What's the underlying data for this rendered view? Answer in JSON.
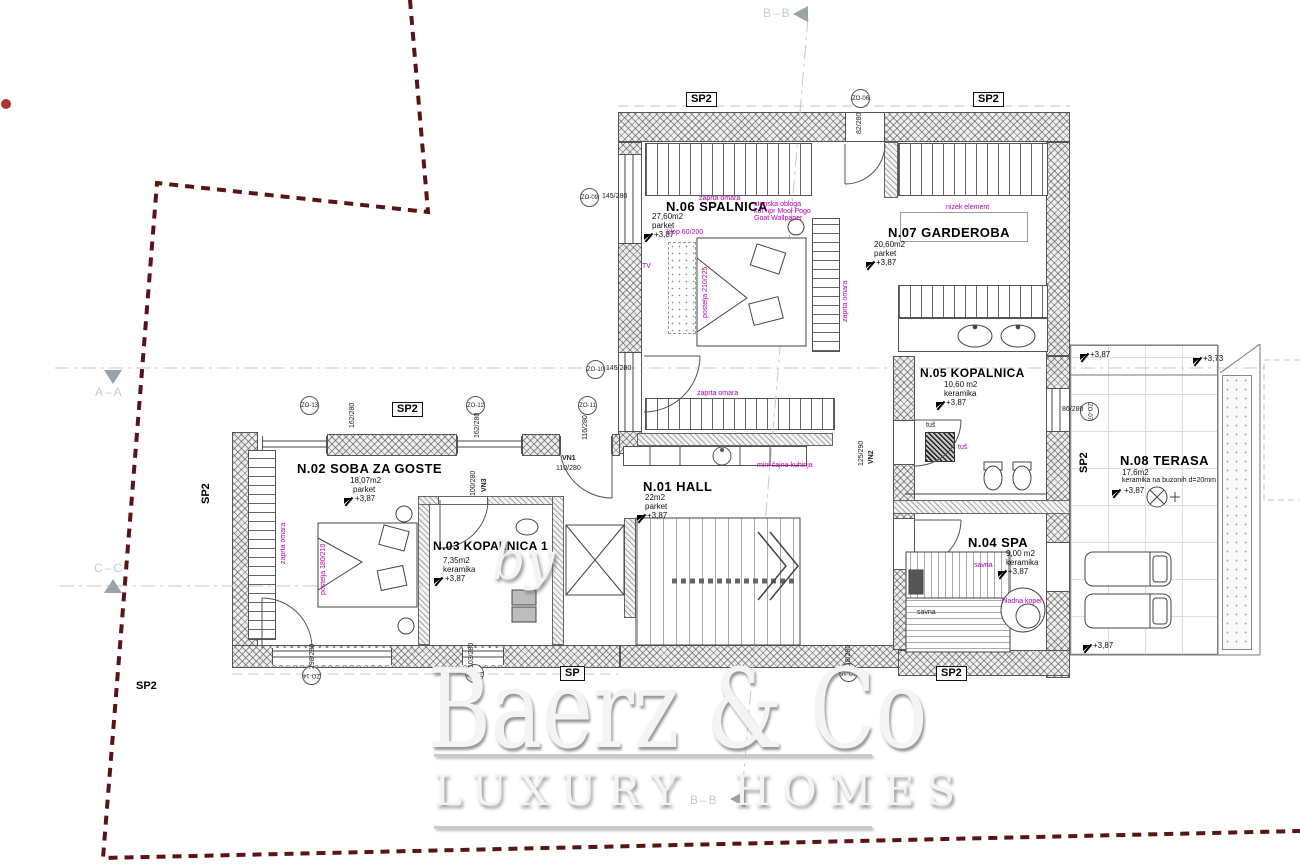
{
  "plan": {
    "markers": {
      "bb": "B–B",
      "aa": "A–A",
      "cc": "C–C"
    },
    "rooms": {
      "n01": {
        "name": "N.01 HALL",
        "area": "22m2",
        "material": "parket",
        "elev": "+3,87"
      },
      "n02": {
        "name": "N.02 SOBA ZA GOSTE",
        "area": "18,07m2",
        "material": "parket",
        "elev": "+3,87"
      },
      "n03": {
        "name": "N.03 KOPALNICA 1",
        "area": "7,35m2",
        "material": "keramika",
        "elev": "+3,87"
      },
      "n04": {
        "name": "N.04 SPA",
        "area": "9,00 m2",
        "material": "keramika",
        "elev": "+3,87"
      },
      "n05": {
        "name": "N.05 KOPALNICA",
        "area": "10,60 m2",
        "material": "keramika",
        "elev": "+3,87"
      },
      "n06": {
        "name": "N.06 SPALNICA",
        "area": "27,60m2",
        "material": "parket",
        "elev": "+3,87"
      },
      "n07": {
        "name": "N.07 GARDEROBA",
        "area": "20,60m2",
        "material": "parket",
        "elev": "+3,87"
      },
      "n08": {
        "name": "N.08 TERASA",
        "area": "17,6m2",
        "material": "keramika na buzonih d=20mm",
        "elev": "+3,87"
      }
    },
    "notes": {
      "zaprta_omara": "zaprta omara",
      "wallpaper1": "stenska obloga",
      "wallpaper2": "kot npr Mool Pogo",
      "wallpaper3": "Goat Wallpaper",
      "klop": "klop 60/200",
      "tv": "TV",
      "postelja_n06": "postelja 210/225",
      "nizek_element": "nizek element",
      "mini_kuhinja": "mini čajna kuhinja",
      "postelja_n02": "postelja 180/210",
      "tus": "tuš",
      "savna": "savna",
      "hladna_kopel": "hladna kopel"
    },
    "openings": {
      "zo06": {
        "code": "ZO-06",
        "size": "82/280"
      },
      "zo07": {
        "code": "ZO-07",
        "size": "86/280"
      },
      "zo09": {
        "code": "ZO-09",
        "size": "145/280"
      },
      "zo10": {
        "code": "ZO-10",
        "size": "145/280"
      },
      "zo11": {
        "code": "ZO-11",
        "size": "116/280"
      },
      "zo12": {
        "code": "ZO-12",
        "size": "162/280"
      },
      "zo13": {
        "code": "ZO-13",
        "size": "162/280"
      },
      "zo14": {
        "code": "ZO-14",
        "size": "298/280"
      },
      "zo15": {
        "code": "ZO-15",
        "size": "218/280"
      },
      "zo16": {
        "code": "ZO-16",
        "size": "103/280"
      }
    },
    "doors": {
      "vn1": {
        "code": "VN1",
        "size": "110/280"
      },
      "vn2": {
        "code": "VN2",
        "size": "125/290"
      },
      "vn3": {
        "code": "VN3",
        "size": "100/280"
      }
    },
    "labels": {
      "sp2": "SP2",
      "sp": "SP"
    },
    "elevations": {
      "e387": "+3,87",
      "e373": "+3,73"
    }
  },
  "watermark": {
    "by": "by",
    "brand": "Baerz & Co",
    "tagline": "LUXURY HOMES"
  },
  "colors": {
    "annotation": "#b400b4",
    "boundary": "#5a1414",
    "marker_gray": "#9aa2ac",
    "red_dot": "#b23232"
  }
}
